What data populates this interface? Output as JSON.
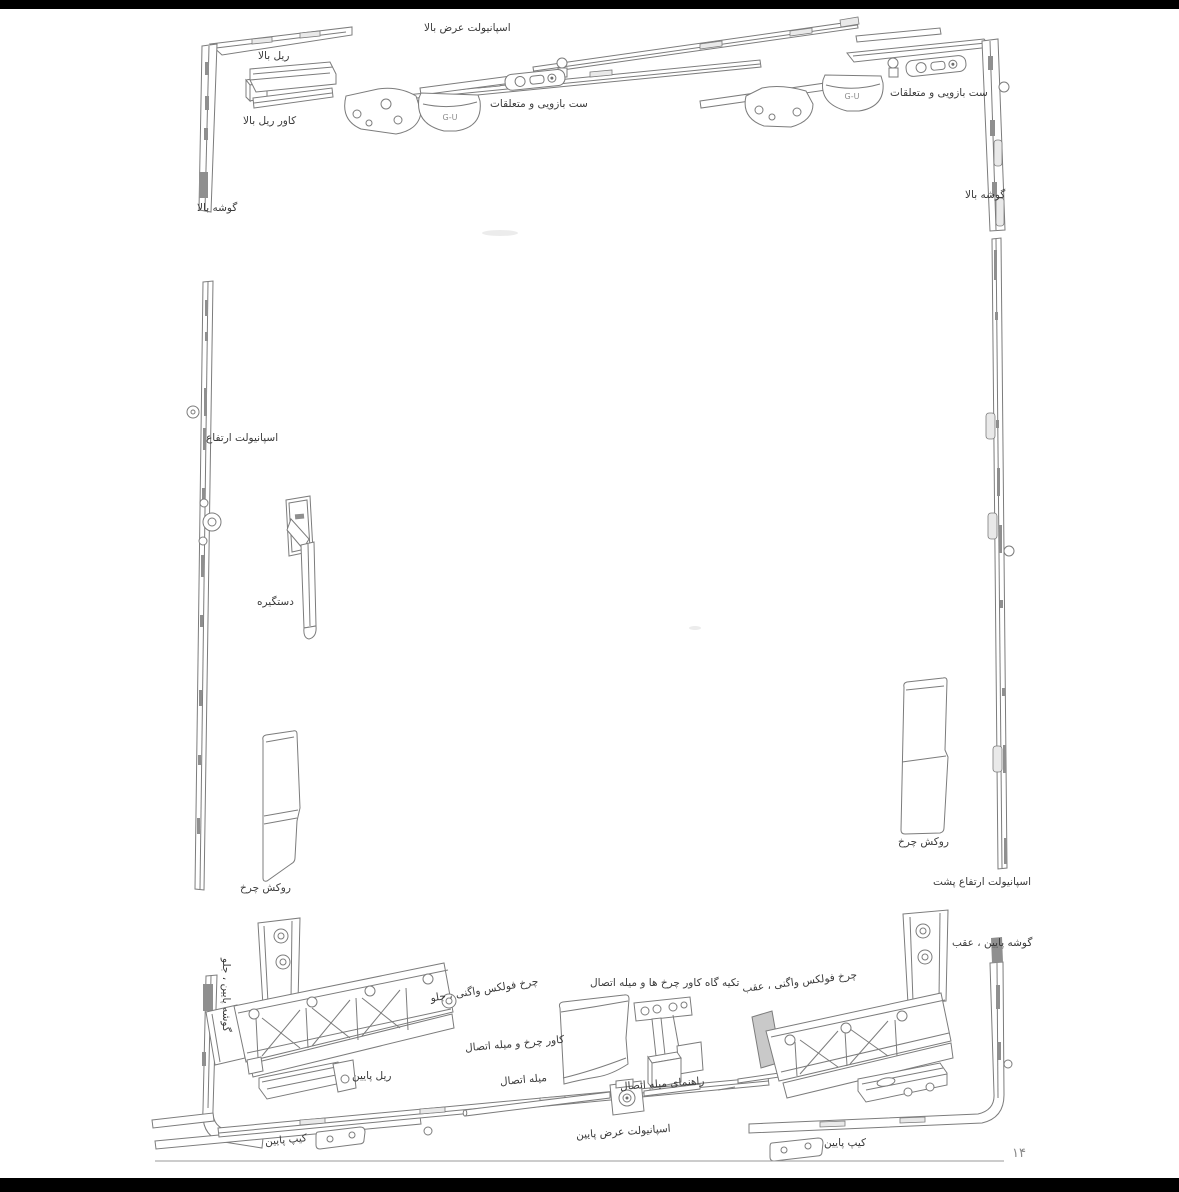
{
  "page": {
    "number_fa": "۱۴",
    "background": "#ffffff",
    "bar_color": "#000000",
    "line_color": "#7c7c7c",
    "text_color": "#3b3b3b"
  },
  "diagram": {
    "brand": "G-U",
    "labels": {
      "top_width_esp": "اسپانیولت عرض بالا",
      "top_rail": "ریل بالا",
      "top_rail_cover": "کاور ریل بالا",
      "arm_set": "ست بازویی و متعلقات",
      "top_corner": "گوشه بالا",
      "height_esp": "اسپانیولت ارتفاع",
      "handle": "دستگیره",
      "wheel_cover": "روکش چرخ",
      "rear_height_esp": "اسپانیولت ارتفاع پشت",
      "bottom_corner_rear": "گوشه پایین ، عقب",
      "bottom_corner_front": "گوشه پایین ، جلو",
      "vw_wheel_front": "چرخ فولکس واگنی ، جلو",
      "vw_wheel_rear": "چرخ فولکس واگنی ، عقب",
      "support": "تکیه گاه کاور چرخ ها و میله اتصال",
      "wheel_cover_rod": "کاور چرخ و میله اتصال",
      "bottom_rail": "ریل پایین",
      "connecting_rod": "میله اتصال",
      "rod_guide": "راهنمای میله اتصال",
      "bottom_width_esp": "اسپانیولت عرض پایین",
      "keep_bottom": "کیپ پایین"
    }
  }
}
